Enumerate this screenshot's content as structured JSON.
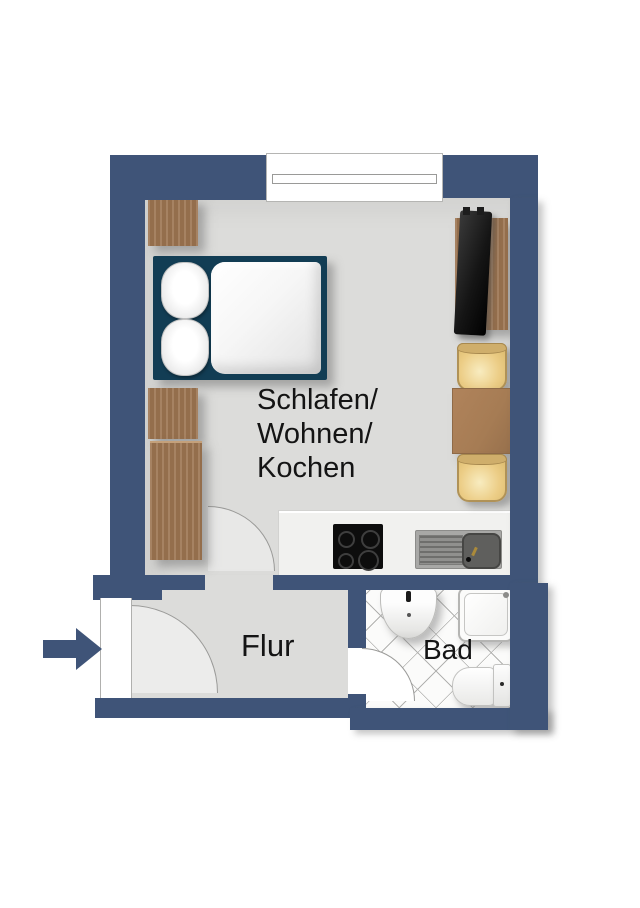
{
  "floorplan": {
    "rooms": {
      "main": {
        "label": "Schlafen/\nWohnen/\nKochen"
      },
      "hallway": {
        "label": "Flur"
      },
      "bathroom": {
        "label": "Bad"
      }
    },
    "colors": {
      "wall": "#3f5478",
      "floor": "#dcdcda",
      "bathroom_floor": "#fbfbfa",
      "tile_line": "#b2b2b0",
      "counter": "#f1f1ef",
      "wood": "#9c7450",
      "table_wood": "#a67c54",
      "bed_frame": "#123d54",
      "bedding": "#ffffff",
      "chair_seat": "#eccd86",
      "cooktop": "#0d0d0d",
      "arrow": "#3f5478",
      "label_text": "#141414"
    }
  }
}
